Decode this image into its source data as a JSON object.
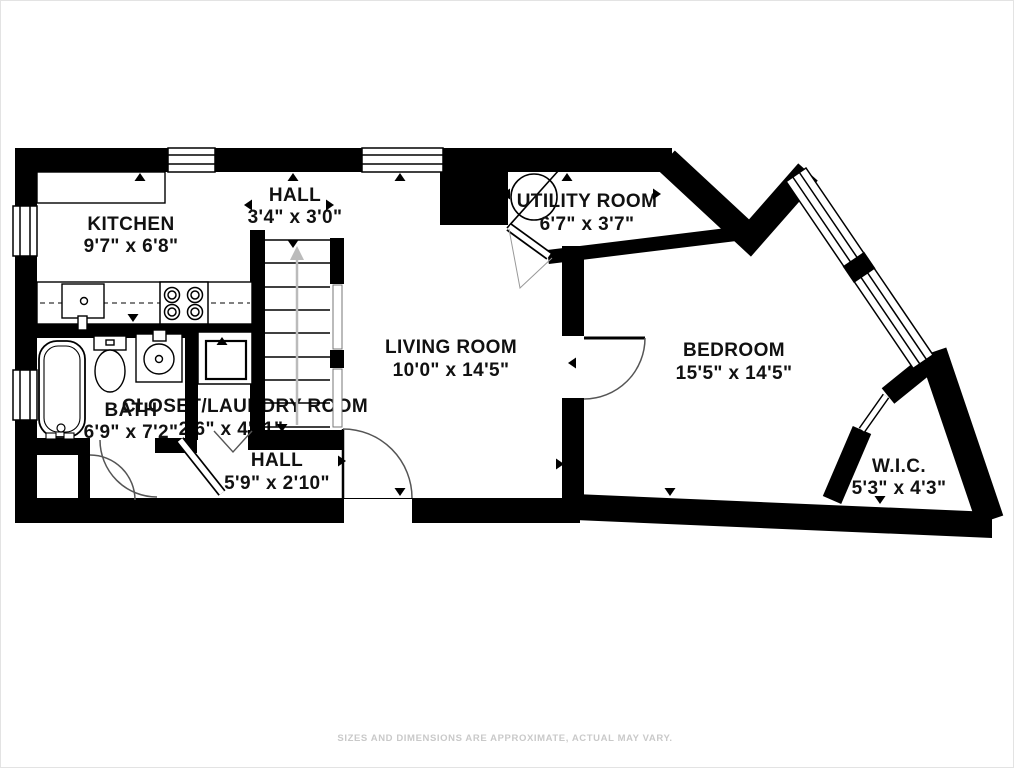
{
  "floorplan": {
    "rooms": [
      {
        "id": "kitchen",
        "name": "KITCHEN",
        "dimensions": "9'7\" x 6'8\""
      },
      {
        "id": "hall-upper",
        "name": "HALL",
        "dimensions": "3'4\" x 3'0\""
      },
      {
        "id": "utility-room",
        "name": "UTILITY ROOM",
        "dimensions": "6'7\" x 3'7\""
      },
      {
        "id": "living-room",
        "name": "LIVING ROOM",
        "dimensions": "10'0\" x 14'5\""
      },
      {
        "id": "bedroom",
        "name": "BEDROOM",
        "dimensions": "15'5\" x 14'5\""
      },
      {
        "id": "bath",
        "name": "BATH",
        "dimensions": "6'9\" x 7'2\""
      },
      {
        "id": "closet-laundry",
        "name": "CLOSET/LAUNDRY ROOM",
        "dimensions": "2'6\" x 4'11\""
      },
      {
        "id": "hall-lower",
        "name": "HALL",
        "dimensions": "5'9\" x 2'10\""
      },
      {
        "id": "wic",
        "name": "W.I.C.",
        "dimensions": "5'3\" x 4'3\""
      }
    ],
    "fixtures": [
      "bathtub",
      "toilet",
      "bathroom-sink",
      "washer",
      "kitchen-counter",
      "kitchen-sink",
      "stove",
      "water-heater",
      "staircase"
    ],
    "disclaimer": "SIZES AND DIMENSIONS ARE APPROXIMATE, ACTUAL MAY VARY.",
    "colors": {
      "wall": "#000000",
      "background": "#ffffff",
      "door_arc": "#555555",
      "stairs_arrow": "#bbbbbb",
      "label_text": "#111111",
      "disclaimer_text": "#c9c9c9"
    }
  }
}
